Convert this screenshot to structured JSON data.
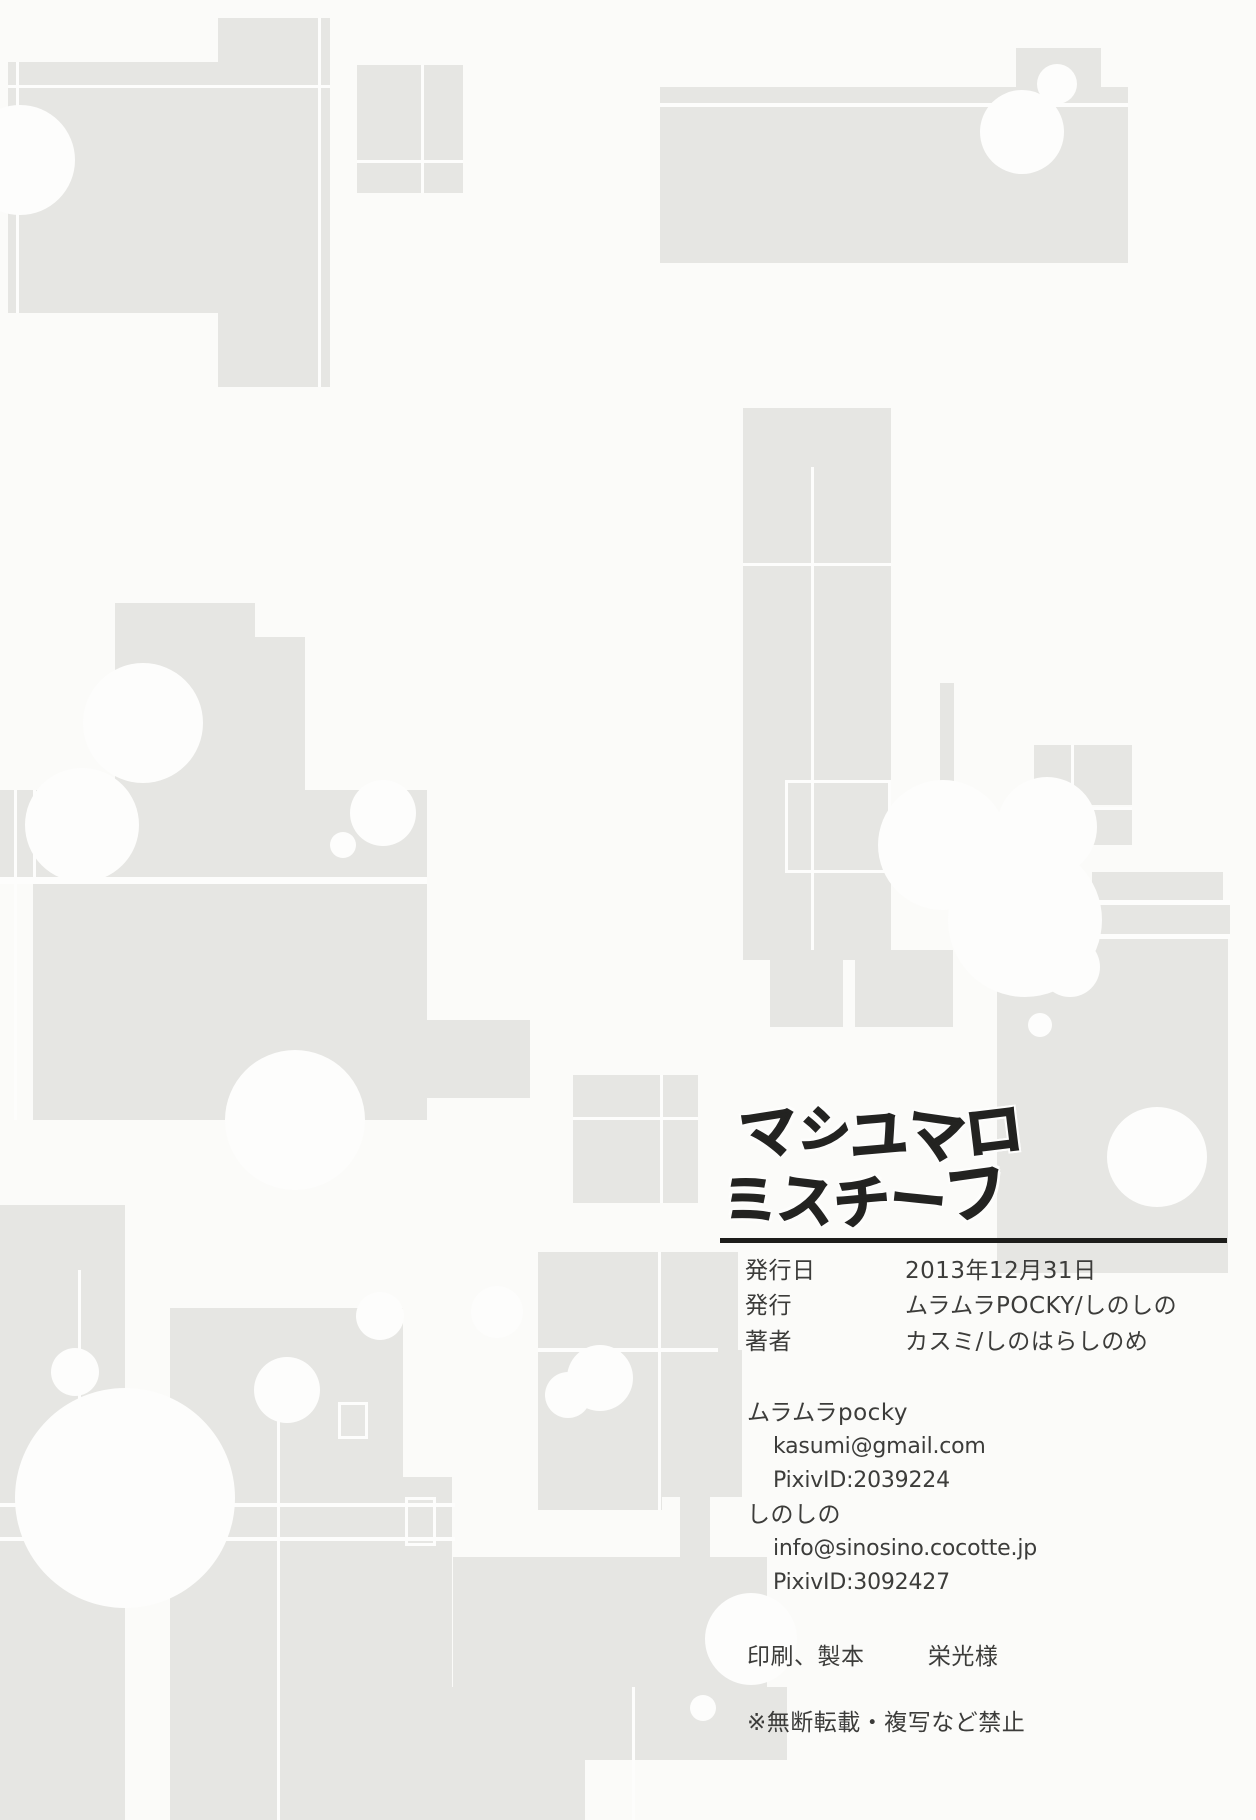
{
  "logo": {
    "line1_chars": [
      "マ",
      "シ",
      "ユ",
      "マ",
      "ロ"
    ],
    "line2_chars": [
      "ミ",
      "ス",
      "チ",
      "ー",
      "フ"
    ]
  },
  "colophon": {
    "rows": [
      {
        "label": "発行日",
        "value": "2013年12月31日"
      },
      {
        "label": "発行",
        "value": "ムラムラPOCKY/しのしの"
      },
      {
        "label": "著者",
        "value": "カスミ/しのはらしのめ"
      }
    ],
    "contacts": [
      {
        "name": "ムラムラpocky",
        "email": "kasumi@gmail.com",
        "pixiv": "PixivID:2039224"
      },
      {
        "name": "しのしの",
        "email": "info@sinosino.cocotte.jp",
        "pixiv": "PixivID:3092427"
      }
    ],
    "printer_label": "印刷、製本",
    "printer_value": "栄光様",
    "notice": "※無断転載・複写など禁止"
  },
  "colors": {
    "paper": "#fbfbf9",
    "shape_gray": "#e6e6e3",
    "text_ink": "#3c3c3a",
    "logo_black": "#232321"
  }
}
